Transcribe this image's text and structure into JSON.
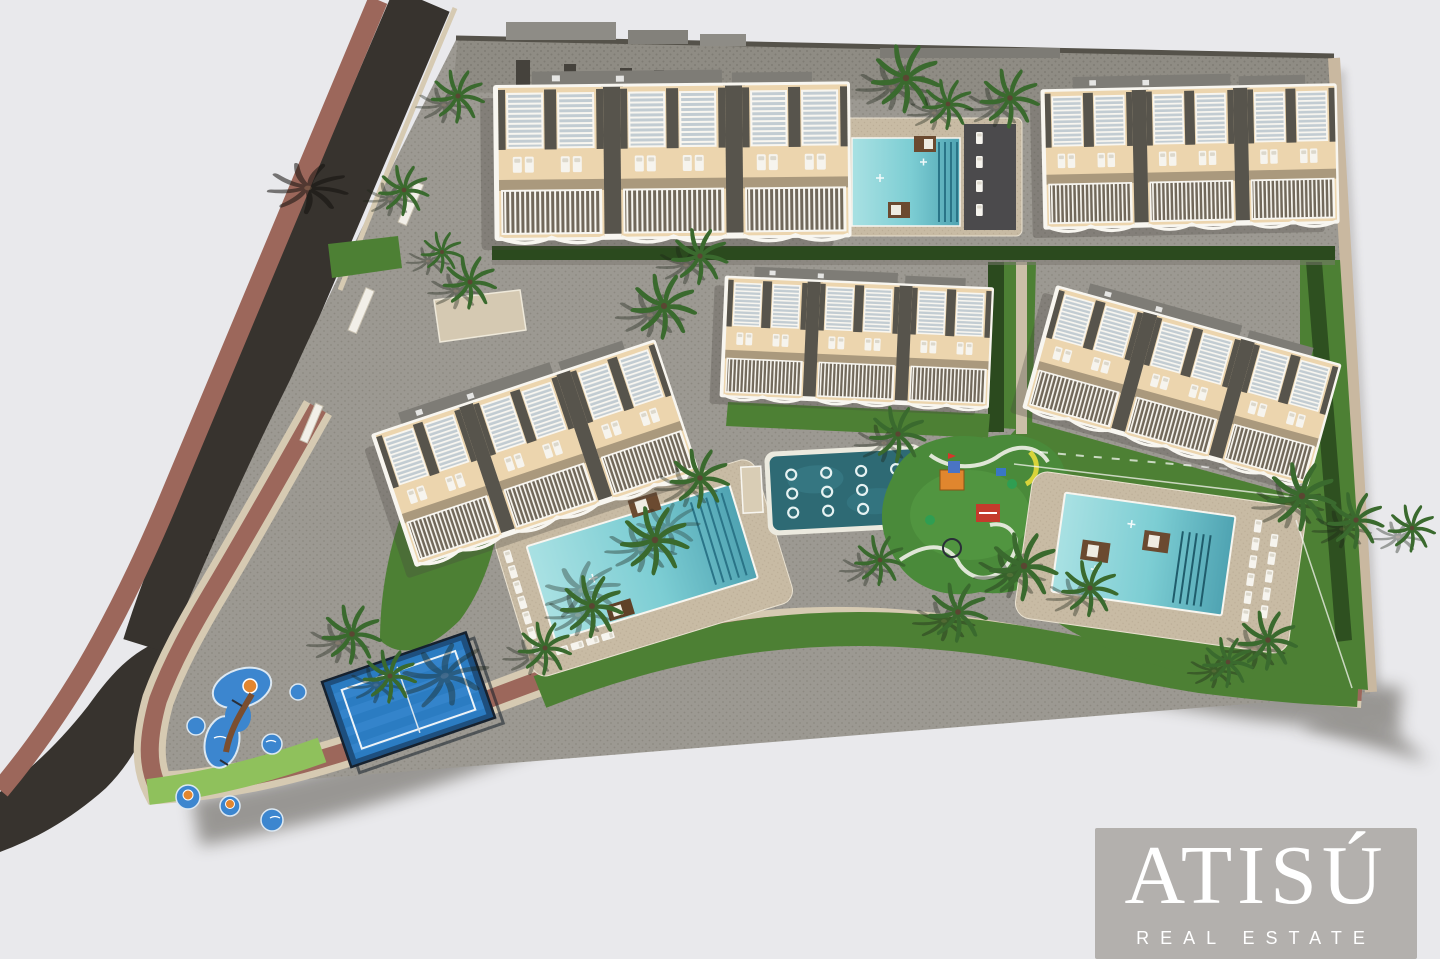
{
  "watermark": {
    "brand": "ATISÚ",
    "tagline": "REAL ESTATE"
  },
  "palette": {
    "bg": "#e9e9ec",
    "asphalt": "#37332e",
    "asphalt_dark": "#2c2925",
    "sidewalk": "#9c675b",
    "curb": "#d6cab2",
    "boundary_curb": "#c9b8a0",
    "paving": "#9c9992",
    "paving_dot": "#8c8981",
    "paving_dark": "#8f8c84",
    "paving_dark_dot": "#7f7c74",
    "deck": "#c8bba4",
    "deck_dot": "#bcae97",
    "grass": "#4d8034",
    "grass_light": "#8fc15c",
    "grass_dark": "#3c6a28",
    "hedge": "#2b4a1e",
    "pool_light": "#a9e1e3",
    "pool_mid": "#7ccdd3",
    "pool_deep": "#4fa3b2",
    "pool_steps": "#2a7487",
    "kids_pool": "#2e6a74",
    "court_blue": "#2b7cc2",
    "court_dark": "#1e4f7e",
    "fence": "#16212e",
    "splash_blue": "#3c86cf",
    "splash_orange": "#e2862f",
    "facade": "#ecd5ae",
    "channel": "#57544c",
    "glass": "#c2ccd2",
    "rails_bg": "#71685a",
    "white_trim": "#f8f6f0",
    "roof": "#7e7c76",
    "roof_light": "#8e8c86",
    "palm": "#3a6a2e",
    "palm_shadow": "#1c2418",
    "trunk": "#5a4632",
    "shadow": "#4a453e",
    "lounger": "#f6f4ee",
    "daybed": "#6b4a30",
    "wall_top": "#55524a",
    "wm_box": "#b3b0ad",
    "wm_text": "#ffffff"
  }
}
